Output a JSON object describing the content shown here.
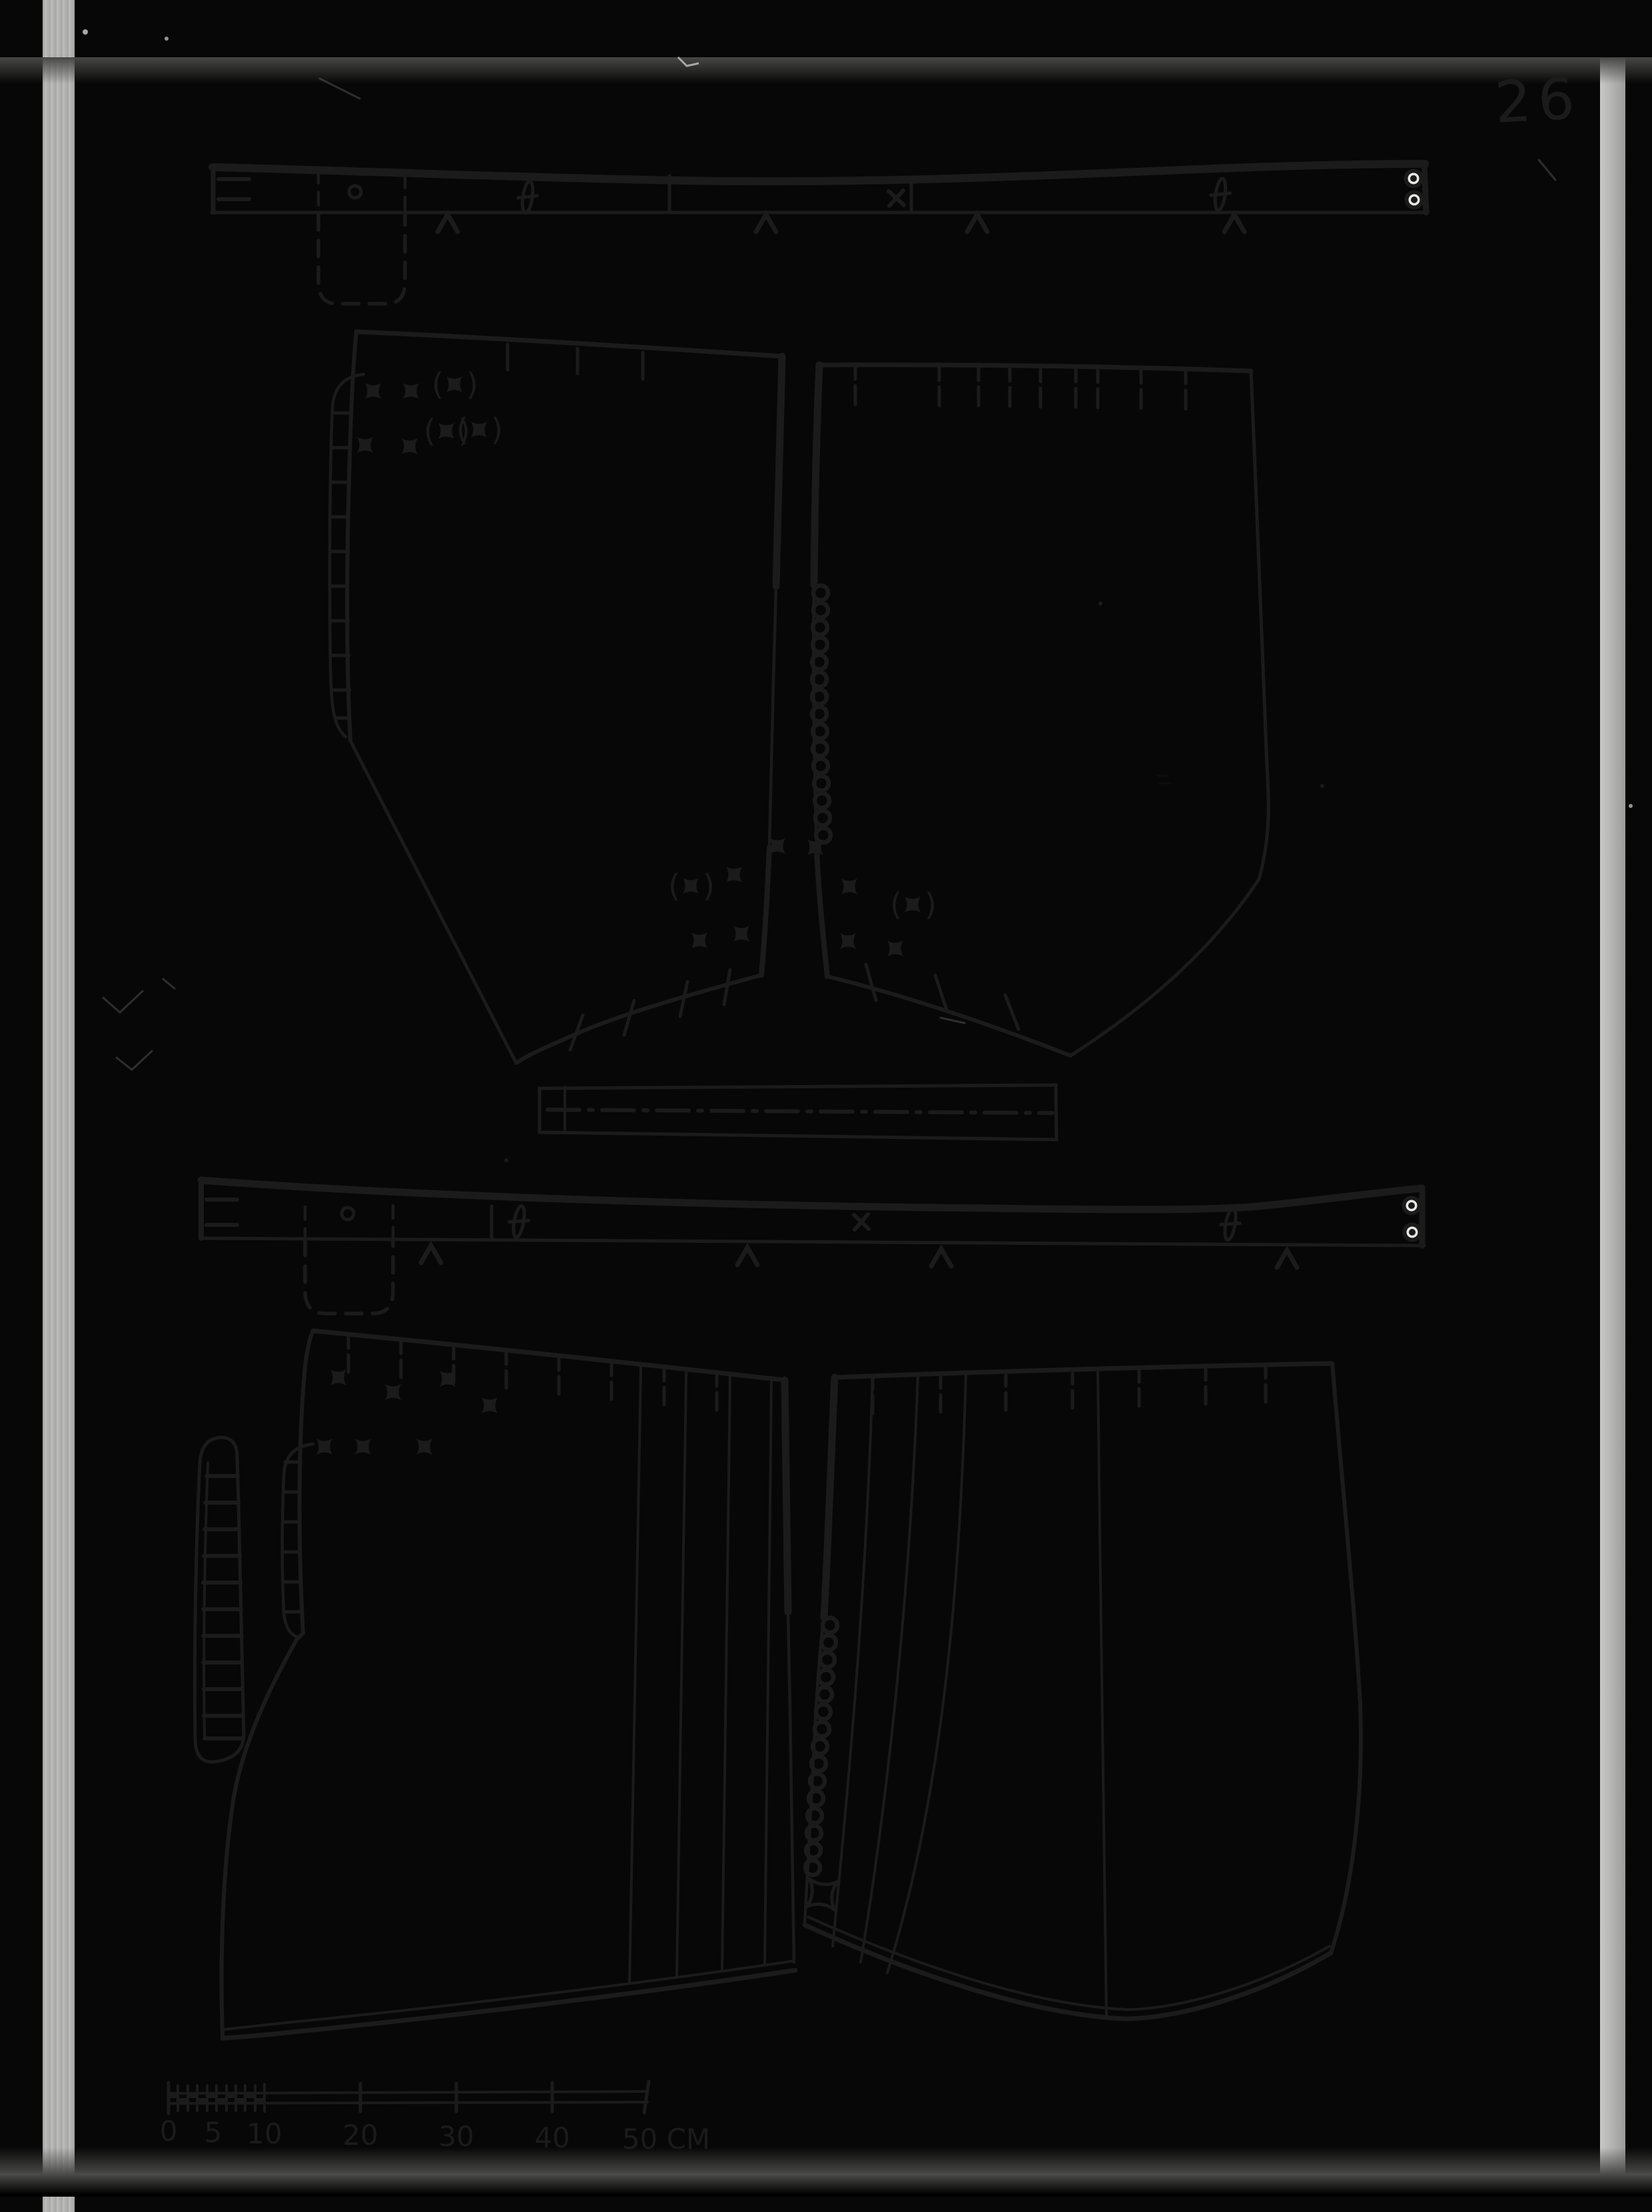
{
  "page_number": "26",
  "scale_bar": {
    "labels": [
      "0",
      "5",
      "10",
      "20",
      "30",
      "40",
      "50 CM"
    ],
    "unit": "cm",
    "range": 50
  },
  "colors": {
    "ink": "#1b1b1b",
    "paper": "#e9e9e7",
    "border": "#070707",
    "film_edge": "#b3b3b1"
  },
  "symbols": {
    "button_mark": "four-point-star",
    "optional_button_mark": "four-point-star-in-parentheses",
    "buttonhole_mark": "vertical-slit-with-bar",
    "eyelet_mark": "double-ring",
    "notch_mark": "chevron",
    "cross_mark": "x",
    "button_circle": "o"
  }
}
